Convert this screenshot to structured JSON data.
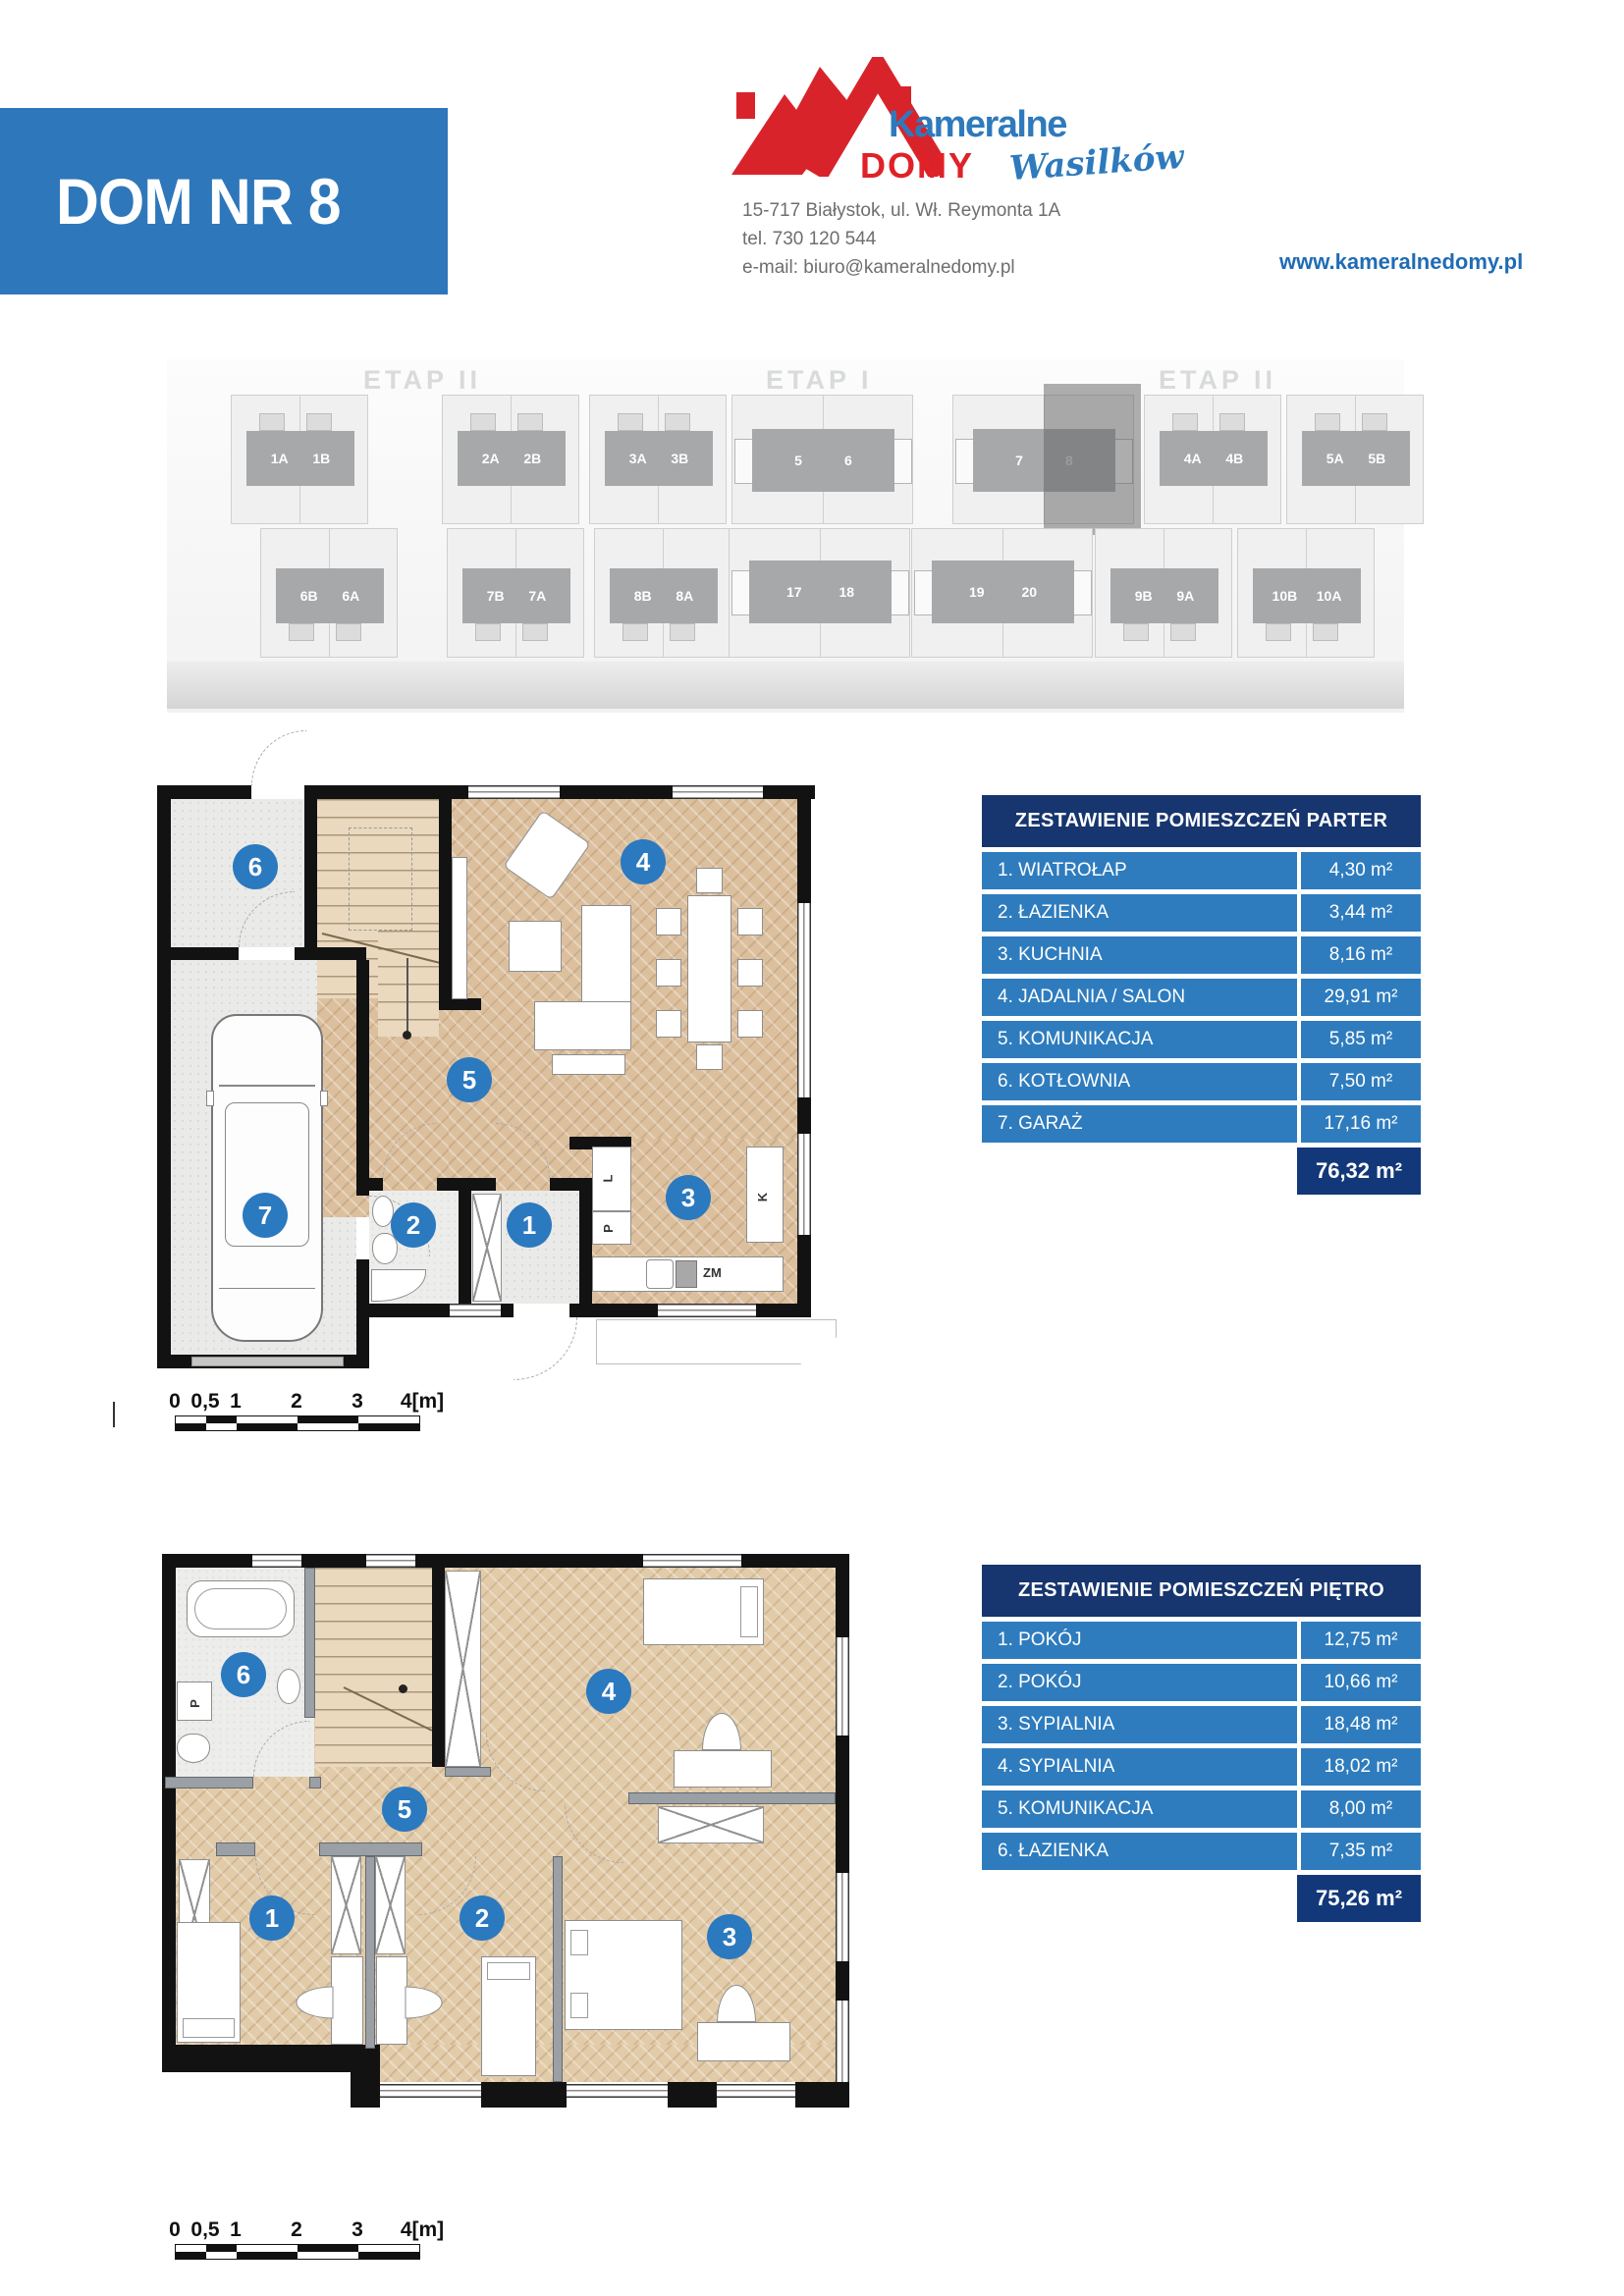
{
  "header": {
    "title": "DOM NR 8",
    "brand_top": "Kameralne",
    "brand_bottom": "DOMY",
    "brand_script": "Wasilków",
    "address_line1": "15-717 Białystok, ul. Wł. Reymonta 1A",
    "address_line2": "tel. 730 120 544",
    "address_line3": "e-mail: biuro@kameralnedomy.pl",
    "website": "www.kameralnedomy.pl"
  },
  "colors": {
    "banner_blue": "#2e77ba",
    "row_blue": "#2e7cbe",
    "navy": "#12387a",
    "badge_blue": "#2b79bf",
    "brand_red": "#d9232b",
    "brand_blue": "#2e7abc"
  },
  "site_plan": {
    "etap_left": "ETAP II",
    "etap_center": "ETAP I",
    "etap_right": "ETAP II",
    "highlighted_unit": "8",
    "top_groups": [
      {
        "a": "1A",
        "b": "1B"
      },
      {
        "a": "2A",
        "b": "2B"
      },
      {
        "a": "3A",
        "b": "3B"
      },
      {
        "a": "5",
        "b": "6"
      },
      {
        "a": "7",
        "b": "8"
      },
      {
        "a": "4A",
        "b": "4B"
      },
      {
        "a": "5A",
        "b": "5B"
      }
    ],
    "bottom_groups": [
      {
        "a": "6B",
        "b": "6A"
      },
      {
        "a": "7B",
        "b": "7A"
      },
      {
        "a": "8B",
        "b": "8A"
      },
      {
        "a": "17",
        "b": "18"
      },
      {
        "a": "19",
        "b": "20"
      },
      {
        "a": "9B",
        "b": "9A"
      },
      {
        "a": "10B",
        "b": "10A"
      }
    ]
  },
  "parter": {
    "table_title": "ZESTAWIENIE POMIESZCZEŃ PARTER",
    "rows": [
      {
        "label": "1. WIATROŁAP",
        "area": "4,30 m²"
      },
      {
        "label": "2. ŁAZIENKA",
        "area": "3,44 m²"
      },
      {
        "label": "3. KUCHNIA",
        "area": "8,16 m²"
      },
      {
        "label": "4. JADALNIA / SALON",
        "area": "29,91 m²"
      },
      {
        "label": "5. KOMUNIKACJA",
        "area": "5,85 m²"
      },
      {
        "label": "6. KOTŁOWNIA",
        "area": "7,50 m²"
      },
      {
        "label": "7. GARAŻ",
        "area": "17,16 m²"
      }
    ],
    "total": "76,32 m²",
    "badges": [
      "1",
      "2",
      "3",
      "4",
      "5",
      "6",
      "7"
    ],
    "kitchen_labels": {
      "l": "L",
      "p": "P",
      "k": "K",
      "zm": "ZM"
    }
  },
  "pietro": {
    "table_title": "ZESTAWIENIE POMIESZCZEŃ PIĘTRO",
    "rows": [
      {
        "label": "1. POKÓJ",
        "area": "12,75 m²"
      },
      {
        "label": "2. POKÓJ",
        "area": "10,66 m²"
      },
      {
        "label": "3. SYPIALNIA",
        "area": "18,48 m²"
      },
      {
        "label": "4. SYPIALNIA",
        "area": "18,02 m²"
      },
      {
        "label": "5. KOMUNIKACJA",
        "area": "8,00 m²"
      },
      {
        "label": "6. ŁAZIENKA",
        "area": "7,35 m²"
      }
    ],
    "total": "75,26 m²",
    "badges": [
      "1",
      "2",
      "3",
      "4",
      "5",
      "6"
    ],
    "washer_label": "P"
  },
  "scale_bar": {
    "labels": [
      "0",
      "0,5",
      "1",
      "2",
      "3",
      "4[m]"
    ]
  }
}
